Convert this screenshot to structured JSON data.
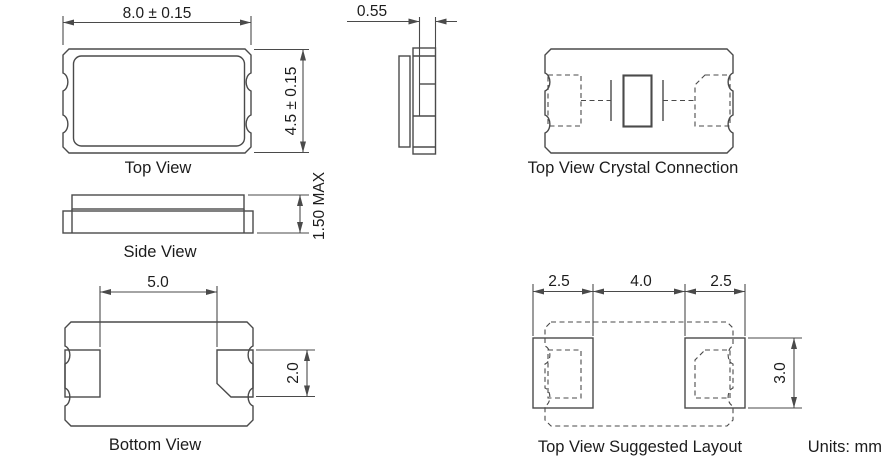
{
  "drawing": {
    "units_note": "Units: mm",
    "top_view": {
      "label": "Top View",
      "width_dim": "8.0 ± 0.15",
      "height_dim": "4.5 ± 0.15"
    },
    "end_view": {
      "lid_dim": "0.55"
    },
    "crystal_connection_view": {
      "label": "Top View Crystal Connection"
    },
    "side_view": {
      "label": "Side View",
      "height_dim": "1.50 MAX"
    },
    "bottom_view": {
      "label": "Bottom View",
      "pad_span_dim": "5.0",
      "pad_height_dim": "2.0"
    },
    "suggested_layout_view": {
      "label": "Top View Suggested Layout",
      "left_pad_dim": "2.5",
      "gap_dim": "4.0",
      "right_pad_dim": "2.5",
      "pad_height_dim": "3.0"
    }
  },
  "colors": {
    "line": "#4a4a4a",
    "text": "#1c1c1c",
    "background": "#ffffff"
  }
}
